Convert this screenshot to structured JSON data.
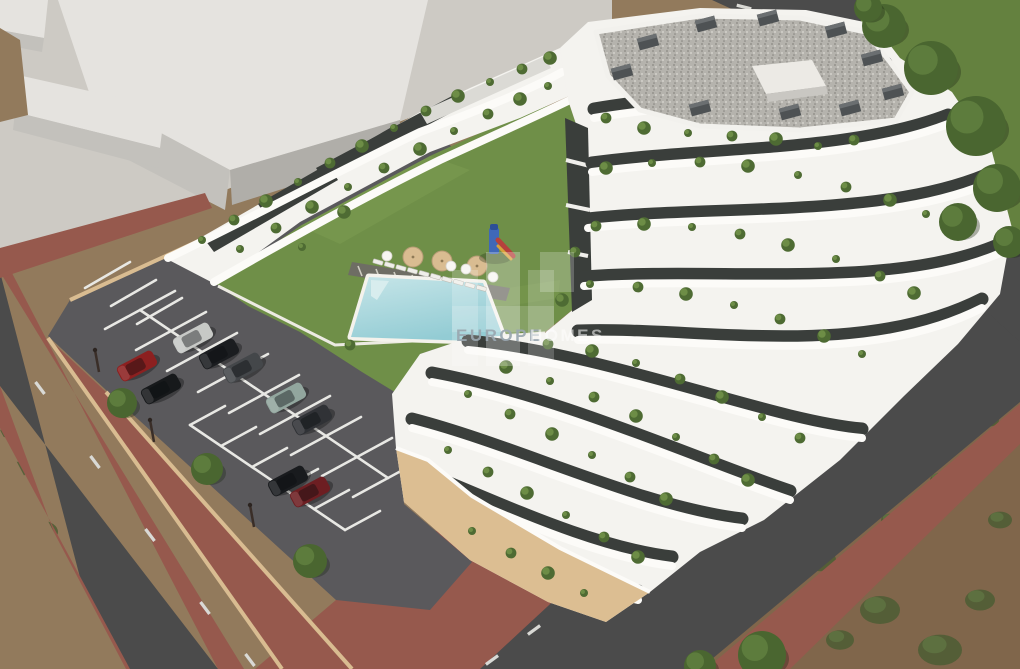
{
  "meta": {
    "type": "architectural-render",
    "subject": "Aerial 3D render of a modern white terraced apartment complex with central lawn courtyard, swimming pool, playground, parking lot with cars, perimeter roads with red-brick sidewalks and undeveloped dirt terrain",
    "width_px": 1020,
    "height_px": 669
  },
  "watermark": {
    "brand_primary": "EUROPE",
    "brand_secondary": "HOMES",
    "full_name": "EUROPE HOMES"
  },
  "palette": {
    "pavement": "#cdcac4",
    "neighborRoof": "#e5e3df",
    "neighborFace": "#c3c1bc",
    "neighborFaceDark": "#b0aea9",
    "dirt": "#927a5c",
    "dirtDark": "#80664b",
    "scrub": "#5d7040",
    "scrubDark": "#4c5d34",
    "grass": "#64813f",
    "treeGreen": "#4a6630",
    "treeLight": "#5d7c3d",
    "road": "#4b4b4b",
    "roadLine": "#d9d9d5",
    "brick": "#96594d",
    "brickDark": "#7f463d",
    "curb": "#d9bc91",
    "parking": "#5a595c",
    "white": "#f4f3ef",
    "parapet": "#fcfbf8",
    "shade": "#dbdad5",
    "win": "#3a3e3b",
    "gravel": "#b7b5af",
    "lawn": "#6f8f48",
    "lawnLight": "#7d9d52",
    "pool": "#b7dde2",
    "poolDeep": "#8fc9d2",
    "sand": "#dcbe92",
    "plant": "#4e6b33",
    "plantLight": "#6d8d46"
  },
  "scene": {
    "parking": {
      "cars": [
        {
          "color": "#c7c9c6",
          "x": 193,
          "y": 338,
          "note": "silver car"
        },
        {
          "color": "#1b1d20",
          "x": 219,
          "y": 354,
          "note": "black car"
        },
        {
          "color": "#44474a",
          "x": 243,
          "y": 368,
          "note": "dark gray car"
        },
        {
          "color": "#8c2020",
          "x": 137,
          "y": 366,
          "note": "red car"
        },
        {
          "color": "#17191b",
          "x": 161,
          "y": 389,
          "note": "black suv"
        },
        {
          "color": "#92a69e",
          "x": 286,
          "y": 398,
          "note": "silver-green suv"
        },
        {
          "color": "#303236",
          "x": 312,
          "y": 420,
          "note": "dark sedan"
        },
        {
          "color": "#191b1e",
          "x": 288,
          "y": 481,
          "note": "black suv"
        },
        {
          "color": "#6d1e22",
          "x": 310,
          "y": 492,
          "note": "dark red car"
        }
      ],
      "car_rotation_deg": -28,
      "rows": [
        {
          "start": [
            105,
            329
          ],
          "step": [
            31,
            21
          ],
          "count": 9,
          "dir": [
            70,
            -38
          ]
        },
        {
          "start": [
            190,
            425
          ],
          "step": [
            31,
            21
          ],
          "count": 6,
          "dir": [
            35,
            -19
          ]
        },
        {
          "start": [
            85,
            288
          ],
          "step": [
            26,
            18
          ],
          "count": 3,
          "dir": [
            45,
            -26
          ]
        }
      ],
      "spines": [
        [
          140,
          310,
          388,
          478
        ],
        [
          190,
          425,
          345,
          530
        ]
      ],
      "median_trees": [
        {
          "x": 122,
          "y": 403,
          "r": 15
        },
        {
          "x": 207,
          "y": 469,
          "r": 16
        },
        {
          "x": 310,
          "y": 561,
          "r": 17
        }
      ],
      "lamps": [
        {
          "x": 150,
          "y": 420
        },
        {
          "x": 250,
          "y": 505
        },
        {
          "x": 95,
          "y": 350
        }
      ]
    },
    "roads": {
      "dash_size": [
        15,
        3.2
      ],
      "left_dashes": {
        "angle": 53,
        "pts": [
          [
            40,
            388
          ],
          [
            95,
            462
          ],
          [
            150,
            535
          ],
          [
            205,
            608
          ],
          [
            250,
            660
          ]
        ]
      },
      "right_dashes": {
        "angle": -36,
        "pts": [
          [
            968,
            308
          ],
          [
            906,
            354
          ],
          [
            844,
            400
          ],
          [
            782,
            446
          ],
          [
            720,
            492
          ],
          [
            658,
            538
          ],
          [
            596,
            584
          ],
          [
            534,
            630
          ],
          [
            492,
            660
          ]
        ]
      },
      "top_dashes": {
        "angle": 14,
        "pts": [
          [
            744,
            7
          ],
          [
            794,
            21
          ]
        ]
      }
    },
    "verge_trees": [
      {
        "x": 884,
        "y": 26,
        "r": 22
      },
      {
        "x": 931,
        "y": 68,
        "r": 27
      },
      {
        "x": 976,
        "y": 126,
        "r": 30
      },
      {
        "x": 997,
        "y": 188,
        "r": 24
      },
      {
        "x": 958,
        "y": 222,
        "r": 19
      },
      {
        "x": 1009,
        "y": 242,
        "r": 16
      },
      {
        "x": 868,
        "y": 8,
        "r": 14
      },
      {
        "x": 762,
        "y": 655,
        "r": 24
      },
      {
        "x": 700,
        "y": 666,
        "r": 16
      }
    ],
    "scrub_patches": [
      {
        "x": 720,
        "y": 470,
        "r": 14
      },
      {
        "x": 760,
        "y": 520,
        "r": 18
      },
      {
        "x": 820,
        "y": 560,
        "r": 16
      },
      {
        "x": 880,
        "y": 610,
        "r": 20
      },
      {
        "x": 940,
        "y": 650,
        "r": 22
      },
      {
        "x": 980,
        "y": 600,
        "r": 15
      },
      {
        "x": 1000,
        "y": 520,
        "r": 12
      },
      {
        "x": 940,
        "y": 480,
        "r": 10
      },
      {
        "x": 890,
        "y": 520,
        "r": 9
      },
      {
        "x": 840,
        "y": 640,
        "r": 14
      },
      {
        "x": 700,
        "y": 560,
        "r": 10
      },
      {
        "x": 660,
        "y": 620,
        "r": 12
      },
      {
        "x": 990,
        "y": 420,
        "r": 9
      },
      {
        "x": 962,
        "y": 388,
        "r": 7
      },
      {
        "x": 15,
        "y": 470,
        "r": 12
      },
      {
        "x": 42,
        "y": 532,
        "r": 16
      },
      {
        "x": 22,
        "y": 590,
        "r": 14
      },
      {
        "x": 58,
        "y": 625,
        "r": 12
      },
      {
        "x": 30,
        "y": 655,
        "r": 15
      },
      {
        "x": 75,
        "y": 660,
        "r": 10
      },
      {
        "x": 8,
        "y": 432,
        "r": 8
      },
      {
        "x": 14,
        "y": 60,
        "r": 10
      },
      {
        "x": 18,
        "y": 95,
        "r": 8
      },
      {
        "x": 640,
        "y": 8,
        "r": 8
      },
      {
        "x": 672,
        "y": 14,
        "r": 6
      }
    ],
    "courtyard": {
      "umbrellas_tan": [
        {
          "x": 413,
          "y": 257,
          "r": 10
        },
        {
          "x": 442,
          "y": 261,
          "r": 10
        },
        {
          "x": 477,
          "y": 266,
          "r": 10
        }
      ],
      "parasols_white": [
        {
          "x": 387,
          "y": 256
        },
        {
          "x": 451,
          "y": 266
        },
        {
          "x": 466,
          "y": 269
        },
        {
          "x": 493,
          "y": 277
        }
      ],
      "loungers": {
        "start": [
          378,
          262
        ],
        "step": [
          11.5,
          2.9
        ],
        "count": 10
      },
      "playground": {
        "x": 489,
        "y": 226,
        "tower_color": "#3f68b8",
        "slide_color": "#b6413c"
      }
    },
    "roof_vents": [
      {
        "x": 648,
        "y": 42
      },
      {
        "x": 706,
        "y": 24
      },
      {
        "x": 768,
        "y": 18
      },
      {
        "x": 836,
        "y": 30
      },
      {
        "x": 872,
        "y": 58
      },
      {
        "x": 893,
        "y": 92
      },
      {
        "x": 622,
        "y": 72
      },
      {
        "x": 700,
        "y": 108
      },
      {
        "x": 790,
        "y": 112
      },
      {
        "x": 850,
        "y": 108
      }
    ],
    "terrace_plants": [
      [
        202,
        240
      ],
      [
        234,
        220
      ],
      [
        266,
        201
      ],
      [
        298,
        182
      ],
      [
        330,
        163
      ],
      [
        362,
        146
      ],
      [
        394,
        128
      ],
      [
        426,
        111
      ],
      [
        458,
        96
      ],
      [
        490,
        82
      ],
      [
        522,
        69
      ],
      [
        550,
        58
      ],
      [
        240,
        249
      ],
      [
        276,
        228
      ],
      [
        312,
        207
      ],
      [
        348,
        187
      ],
      [
        384,
        168
      ],
      [
        420,
        149
      ],
      [
        454,
        131
      ],
      [
        488,
        114
      ],
      [
        520,
        99
      ],
      [
        548,
        86
      ],
      [
        606,
        118
      ],
      [
        644,
        128
      ],
      [
        688,
        133
      ],
      [
        732,
        136
      ],
      [
        776,
        139
      ],
      [
        818,
        146
      ],
      [
        854,
        140
      ],
      [
        606,
        168
      ],
      [
        652,
        163
      ],
      [
        700,
        162
      ],
      [
        748,
        166
      ],
      [
        798,
        175
      ],
      [
        846,
        187
      ],
      [
        890,
        200
      ],
      [
        926,
        214
      ],
      [
        596,
        226
      ],
      [
        644,
        224
      ],
      [
        692,
        227
      ],
      [
        740,
        234
      ],
      [
        788,
        245
      ],
      [
        836,
        259
      ],
      [
        880,
        276
      ],
      [
        914,
        293
      ],
      [
        590,
        284
      ],
      [
        638,
        287
      ],
      [
        686,
        294
      ],
      [
        734,
        305
      ],
      [
        780,
        319
      ],
      [
        824,
        336
      ],
      [
        862,
        354
      ],
      [
        548,
        344
      ],
      [
        592,
        351
      ],
      [
        636,
        363
      ],
      [
        680,
        379
      ],
      [
        722,
        397
      ],
      [
        762,
        417
      ],
      [
        800,
        438
      ],
      [
        506,
        367
      ],
      [
        550,
        381
      ],
      [
        594,
        397
      ],
      [
        636,
        416
      ],
      [
        676,
        437
      ],
      [
        714,
        459
      ],
      [
        748,
        480
      ],
      [
        468,
        394
      ],
      [
        510,
        414
      ],
      [
        552,
        434
      ],
      [
        592,
        455
      ],
      [
        630,
        477
      ],
      [
        666,
        499
      ],
      [
        448,
        450
      ],
      [
        488,
        472
      ],
      [
        527,
        493
      ],
      [
        566,
        515
      ],
      [
        604,
        537
      ],
      [
        638,
        557
      ],
      [
        472,
        531
      ],
      [
        511,
        553
      ],
      [
        548,
        573
      ],
      [
        584,
        593
      ],
      [
        350,
        345
      ],
      [
        344,
        212
      ],
      [
        302,
        247
      ],
      [
        575,
        252
      ],
      [
        562,
        300
      ]
    ]
  }
}
